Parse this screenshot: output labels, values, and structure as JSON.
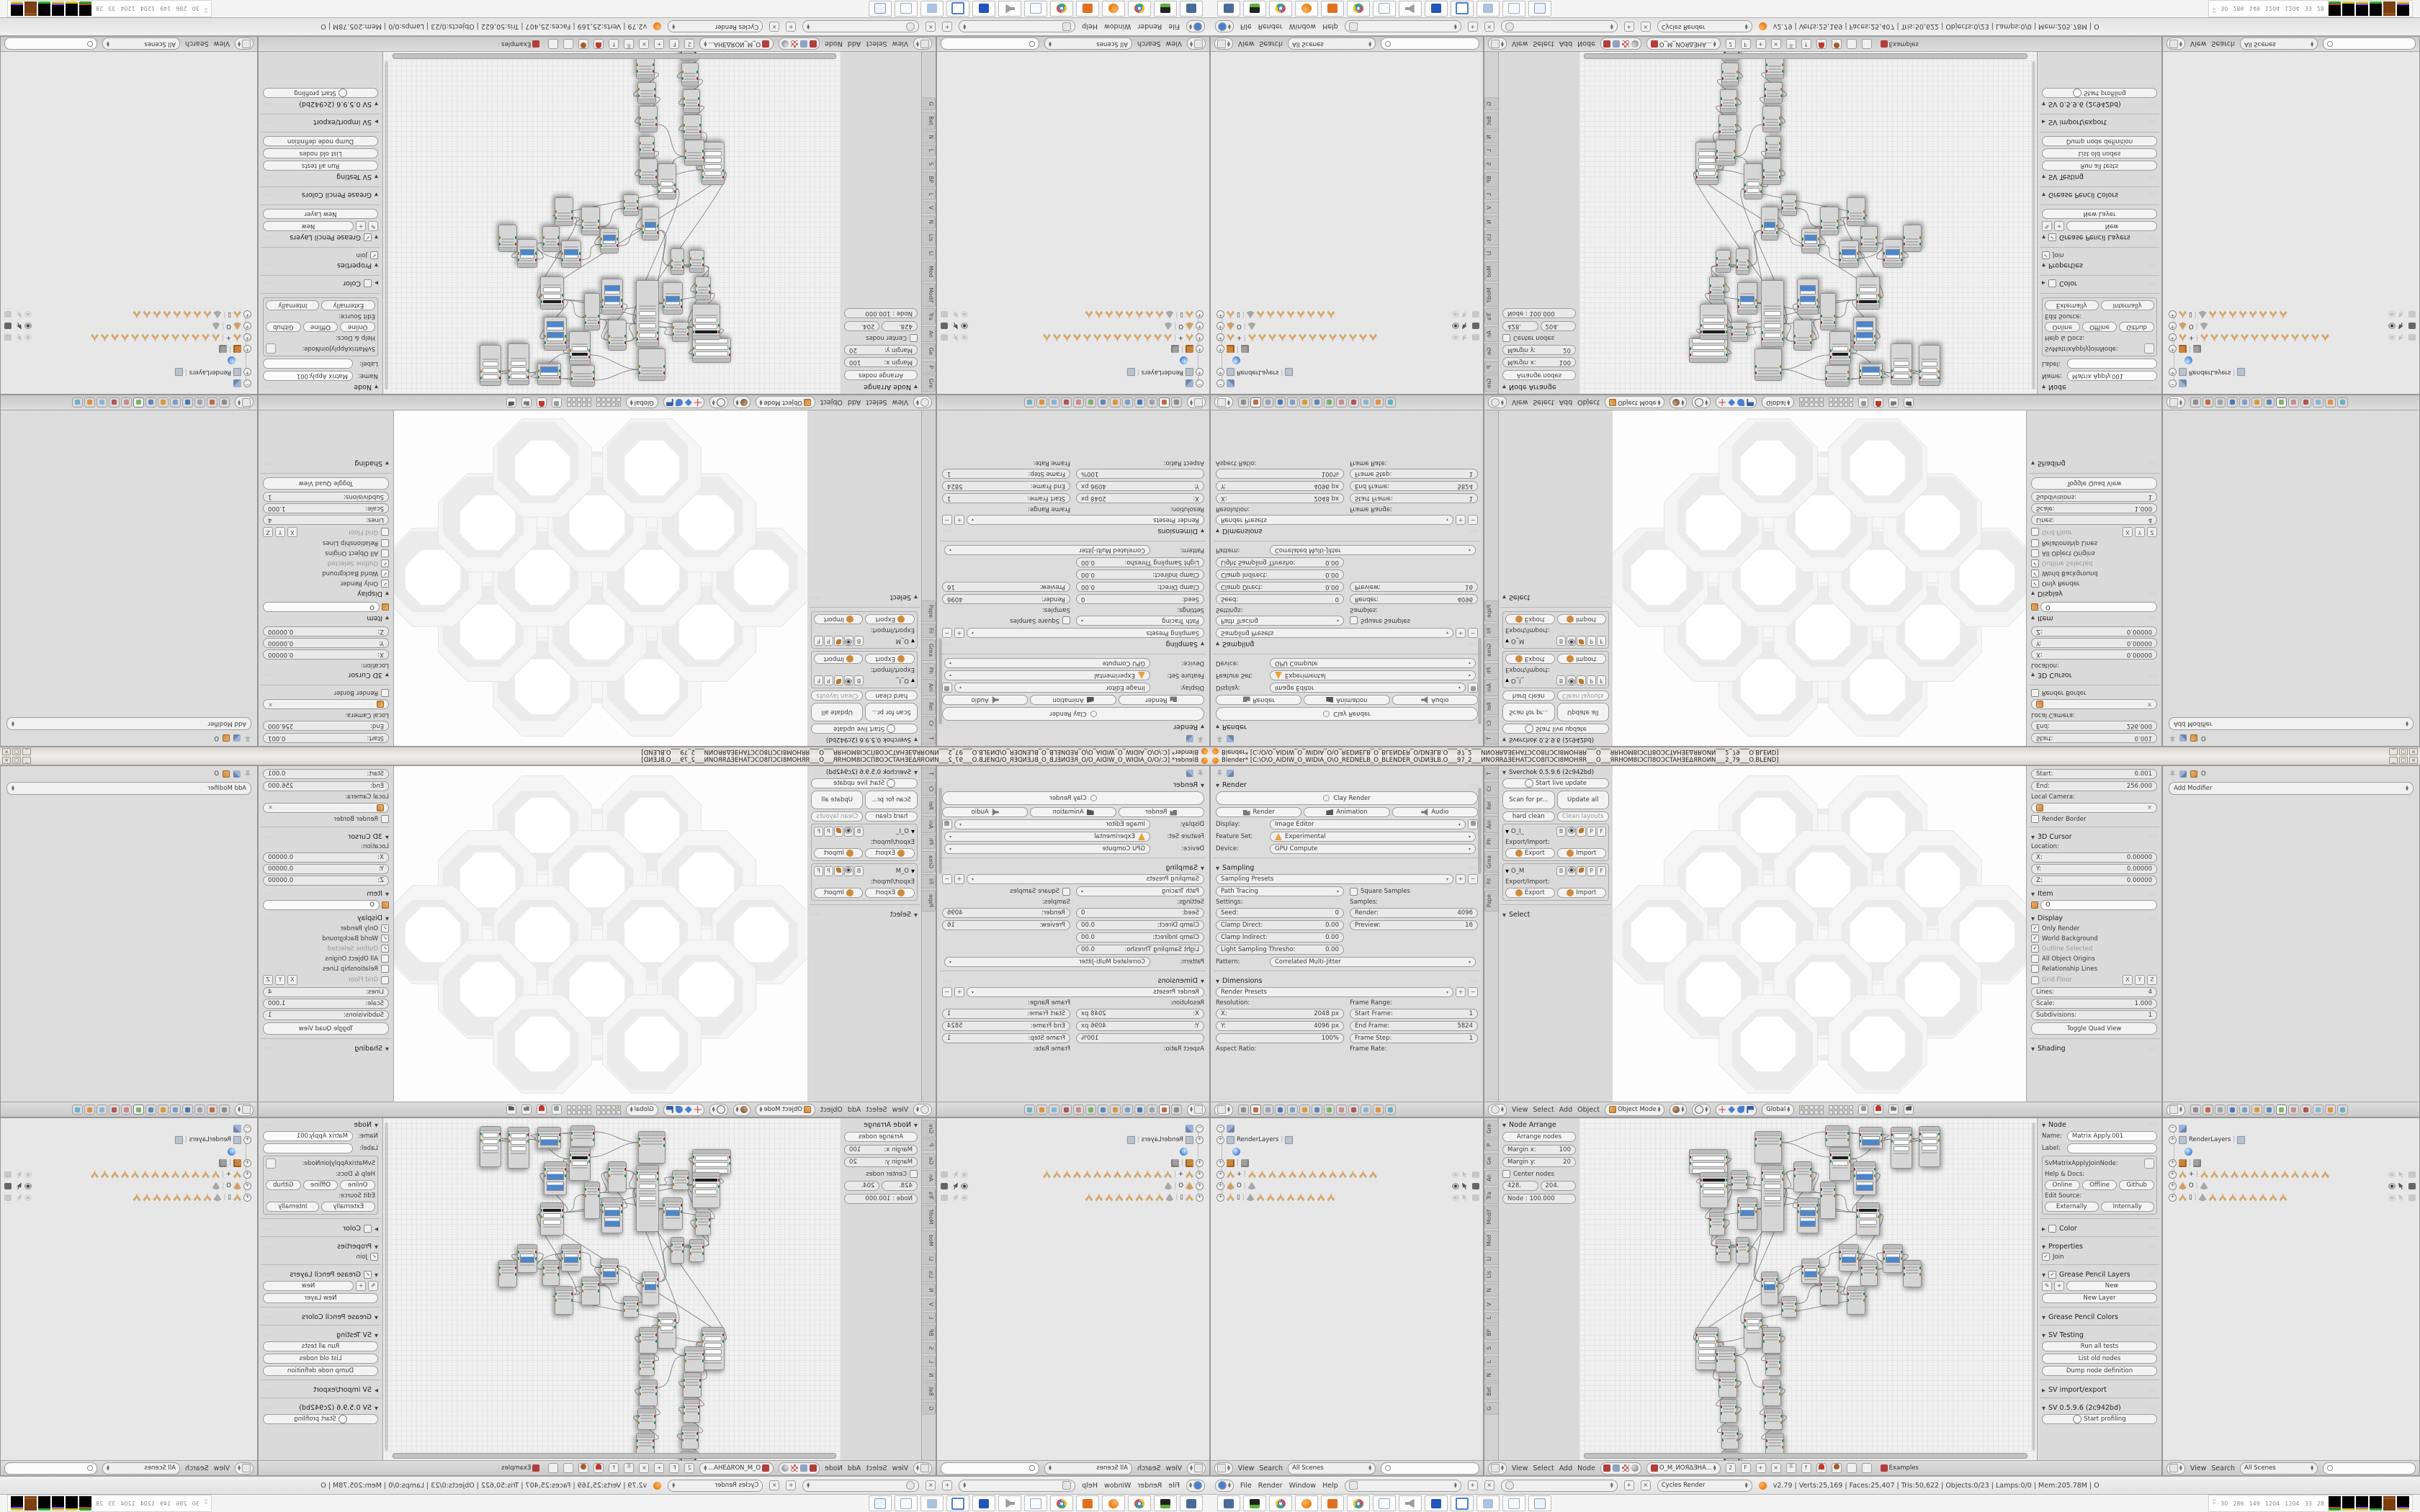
{
  "window": {
    "title": "Blender* [C:\\O\\O_AIDIW_O_WIDIA_O\\O_REDNELB_O_BLENDER_O\\DИƎLB.O___97_2___ИNOЯRΔƎEHATƆCO8ПƆCI8MOHЯR___O___ЯRHOM8IƆCП8OƆCTAHƎEΔЯROИN___2_79___O.BLEND]",
    "controls": [
      "_",
      "□",
      "×"
    ]
  },
  "accent": {
    "blender_orange": "#e87d0d",
    "slider_blue": "#4d86cc",
    "selection_tan": "#d6a76f"
  },
  "props1": {
    "render": {
      "title": "Render",
      "clay": "Clay Render",
      "r3": [
        "Render",
        "Animation",
        "Audio"
      ],
      "display_l": "Display:",
      "display": "Image Editor",
      "feature_l": "Feature Set:",
      "feature": "Experimental",
      "device_l": "Device:",
      "device": "GPU Compute"
    },
    "sampling": {
      "title": "Sampling",
      "presets": "Sampling Presets",
      "integrator": "Path Tracing",
      "square": "Square Samples",
      "settings_l": "Settings:",
      "samples_l": "Samples:",
      "left": [
        [
          "Seed:",
          "0"
        ],
        [
          "Clamp Direct:",
          "0.00"
        ],
        [
          "Clamp Indirect:",
          "0.00"
        ],
        [
          "Light Sampling Thresho:",
          "0.00"
        ]
      ],
      "right": [
        [
          "Render:",
          "4096"
        ],
        [
          "Preview:",
          "16"
        ]
      ],
      "pattern_l": "Pattern:",
      "pattern": "Correlated Multi-Jitter"
    },
    "dimensions": {
      "title": "Dimensions",
      "presets": "Render Presets",
      "res_l": "Resolution:",
      "range_l": "Frame Range:",
      "left": [
        [
          "X:",
          "2048 px"
        ],
        [
          "Y:",
          "4096 px"
        ],
        [
          "",
          "100%"
        ]
      ],
      "right": [
        [
          "Start Frame:",
          "1"
        ],
        [
          "End Frame:",
          "5824"
        ],
        [
          "Frame Step:",
          "1"
        ]
      ],
      "aspect_l": "Aspect Ratio:",
      "rate_l": "Frame Rate:"
    }
  },
  "shelf3d": {
    "tabs": [
      "T",
      "Cr",
      "Rel",
      "Ani",
      "Ph",
      "Grea",
      "Fil",
      "Pape"
    ],
    "title": "Sverchok 0.5.9.6 (2c942bd)",
    "live": "Start live update",
    "pair1": [
      "Scan for pr...",
      "Update all"
    ],
    "pair2": [
      "hard clean",
      "Clean layouts"
    ],
    "io_boxes": [
      {
        "label": "O_I_"
      },
      {
        "label": "O_M"
      }
    ],
    "io_btns": [
      "B",
      "P",
      "F"
    ],
    "exio_l": "Export/Import:",
    "exp": "Export",
    "imp": "Import",
    "select_t": "Select"
  },
  "npanel3d": {
    "clip": [
      [
        "Start:",
        "0.001"
      ],
      [
        "End:",
        "256.000"
      ]
    ],
    "localcam_l": "Local Camera:",
    "renderborder": "Render Border",
    "cursor_t": "3D Cursor",
    "location_l": "Location:",
    "loc": [
      [
        "X:",
        "0.00000"
      ],
      [
        "Y:",
        "0.00000"
      ],
      [
        "Z:",
        "0.00000"
      ]
    ],
    "item_t": "Item",
    "item_val": "O",
    "display_t": "Display",
    "checks": [
      {
        "t": "Only Render",
        "c": 1
      },
      {
        "t": "World Background",
        "c": 1
      },
      {
        "t": "Outline Selected",
        "c": 1,
        "dim": 1
      },
      {
        "t": "All Object Origins",
        "c": 0
      },
      {
        "t": "Relationship Lines",
        "c": 0
      }
    ],
    "gridfloor": "Grid Floor",
    "xyz": [
      "X",
      "Y",
      "Z"
    ],
    "gridvals": [
      [
        "Lines:",
        "4"
      ],
      [
        "Scale:",
        "1.000"
      ],
      [
        "Subdivisions:",
        "1"
      ]
    ],
    "quadview": "Toggle Quad View",
    "shading_t": "Shading"
  },
  "props2": {
    "crumb_obj": "O",
    "add_modifier": "Add Modifier"
  },
  "hdr3d": {
    "menus": [
      "View",
      "Select",
      "Add",
      "Object"
    ],
    "mode": "Object Mode",
    "space": "Global"
  },
  "outliner": {
    "menus": [
      "View",
      "Search"
    ],
    "scenes": "All Scenes",
    "rows": [
      {
        "e": "-",
        "i": [
          "tools"
        ],
        "t": ""
      },
      {
        "e": "+",
        "i": [
          "pic"
        ],
        "t": "RenderLayers",
        "x": [
          "pic"
        ]
      },
      {
        "e": "",
        "i": [
          "world"
        ],
        "t": "",
        "ind": 1
      },
      {
        "e": "+",
        "i": [
          "blocks"
        ],
        "t": "",
        "x": [
          "blocksg"
        ]
      },
      {
        "e": "+",
        "i": [
          "tri"
        ],
        "t": "+",
        "x": [
          "tri",
          "tri",
          "tri",
          "tri",
          "tri",
          "tri",
          "tri",
          "tri",
          "tri",
          "tri",
          "tri",
          "tri",
          "tri"
        ],
        "v": 0
      },
      {
        "e": "+",
        "i": [
          "cone"
        ],
        "t": "O",
        "x": [
          "coneg"
        ],
        "v": 1
      },
      {
        "e": "+",
        "i": [
          "tri"
        ],
        "t": "▯",
        "x": [
          "coneg",
          "tri",
          "tri",
          "tri",
          "tri",
          "tri",
          "tri",
          "tri",
          "tri"
        ],
        "v": 0
      }
    ]
  },
  "nodeshelf": {
    "tabs": [
      "Gre",
      "P",
      "Ge",
      "An",
      "Tra",
      "Modif",
      "Mod",
      "Li",
      "Lis",
      "N",
      "V",
      "L",
      "BP",
      "S",
      "L",
      "N",
      "Bet",
      "G"
    ],
    "title": "Node Arrange",
    "arrange": "Arrange nodes",
    "kv": [
      [
        "Margin x:",
        "100"
      ],
      [
        "Margin y:",
        "20"
      ]
    ],
    "center": "Center nodes",
    "pair": [
      "428.",
      "204."
    ],
    "node100": "Node : 100.000"
  },
  "nodenp": {
    "title": "Node",
    "name_l": "Name:",
    "name": "Matrix Apply.001",
    "label_l": "Label:",
    "cls": "SvMatrixApplyJoinNode:",
    "help_l": "Help & Docs:",
    "docs": [
      "Online",
      "Offline",
      "Github"
    ],
    "editsrc_l": "Edit Source:",
    "src": [
      "Externally",
      "Internally"
    ],
    "color_t": "Color",
    "props_t": "Properties",
    "join": "Join",
    "gpl_t": "Grease Pencil Layers",
    "new_b": "New",
    "newlayer_b": "New Layer",
    "gpc_t": "Grease Pencil Colors",
    "svtest_t": "SV Testing",
    "tests": [
      "Run all tests",
      "List old nodes",
      "Dump node definition"
    ],
    "svio_t": "SV import/export",
    "svver_t": "SV 0.5.9.6 (2c942bd)",
    "profiling": "Start profiling"
  },
  "nodehdr": {
    "menus": [
      "View",
      "Select",
      "Add",
      "Node"
    ],
    "tree": "O_M_ИOЯΔƎHA...",
    "num": "2",
    "f": "F",
    "examples": "Examples"
  },
  "infobar": {
    "menus": [
      "File",
      "Render",
      "Window",
      "Help"
    ],
    "engine": "Cycles Render",
    "stats": "v2.79 | Verts:25,169 | Faces:25,407 | Tris:50,622 | Objects:0/23 | Lamps:0/0 | Mem:205.78M | O"
  },
  "taskbar": {
    "icons": [
      "monitor",
      "drive",
      "chrome",
      "blender",
      "swirl",
      "chrome",
      "note",
      "speaker",
      "floppy",
      "frame",
      "calc",
      "note",
      "note2"
    ],
    "tray_nums": [
      "30",
      "286",
      "149",
      "1204",
      "1204",
      "33",
      "28"
    ],
    "tray_graphs": [
      [
        "#27a327",
        "#c03c2e"
      ],
      [
        "#d6c42a"
      ],
      [
        "#d6c42a",
        "#8a3cf0"
      ],
      [
        "#2fb52f"
      ],
      [
        "#8a4a17"
      ],
      [
        "#d6c42a",
        "#8a3cf0"
      ]
    ]
  },
  "lattice": {
    "r": 74,
    "cells": [
      [
        216,
        82
      ],
      [
        368,
        82
      ],
      [
        140,
        158
      ],
      [
        292,
        158
      ],
      [
        444,
        158
      ],
      [
        64,
        234
      ],
      [
        216,
        234
      ],
      [
        368,
        234
      ],
      [
        520,
        234
      ],
      [
        140,
        310
      ],
      [
        292,
        310
      ],
      [
        444,
        310
      ],
      [
        216,
        386
      ],
      [
        368,
        386
      ]
    ]
  },
  "node_graph": {
    "nodes": [
      [
        152,
        43,
        54,
        35,
        "s"
      ],
      [
        243,
        18,
        38,
        45,
        "c"
      ],
      [
        341,
        10,
        34,
        30,
        "c"
      ],
      [
        388,
        12,
        33,
        31,
        "b"
      ],
      [
        432,
        12,
        30,
        58,
        "s"
      ],
      [
        347,
        40,
        30,
        47,
        "k"
      ],
      [
        380,
        60,
        32,
        47,
        "B"
      ],
      [
        167,
        75,
        39,
        50,
        "kf"
      ],
      [
        210,
        72,
        24,
        28,
        "c"
      ],
      [
        219,
        110,
        28,
        45,
        "b"
      ],
      [
        252,
        65,
        32,
        93,
        "t"
      ],
      [
        297,
        60,
        26,
        43,
        "c"
      ],
      [
        302,
        110,
        30,
        50,
        "B"
      ],
      [
        334,
        88,
        22,
        52,
        "c"
      ],
      [
        384,
        117,
        33,
        46,
        "kf"
      ],
      [
        180,
        130,
        22,
        33,
        "c"
      ],
      [
        189,
        168,
        21,
        32,
        "c"
      ],
      [
        217,
        165,
        19,
        37,
        "c"
      ],
      [
        252,
        213,
        24,
        47,
        "b"
      ],
      [
        280,
        247,
        22,
        30,
        "c"
      ],
      [
        308,
        195,
        26,
        35,
        "b"
      ],
      [
        334,
        220,
        26,
        40,
        "c"
      ],
      [
        360,
        175,
        28,
        38,
        "b"
      ],
      [
        390,
        197,
        24,
        36,
        "c"
      ],
      [
        421,
        175,
        28,
        40,
        "b"
      ],
      [
        449,
        197,
        26,
        38,
        "c"
      ],
      [
        371,
        233,
        26,
        40,
        "c"
      ],
      [
        228,
        270,
        26,
        50,
        "f"
      ],
      [
        161,
        290,
        32,
        60,
        "F"
      ],
      [
        189,
        317,
        28,
        36,
        "c"
      ],
      [
        254,
        290,
        26,
        37,
        "c"
      ],
      [
        258,
        328,
        22,
        30,
        "c"
      ],
      [
        193,
        353,
        26,
        35,
        "c"
      ],
      [
        195,
        390,
        24,
        33,
        "c"
      ],
      [
        197,
        427,
        24,
        33,
        "c"
      ],
      [
        200,
        463,
        23,
        27,
        "c"
      ],
      [
        254,
        363,
        26,
        37,
        "c"
      ],
      [
        256,
        403,
        26,
        30,
        "c"
      ],
      [
        258,
        437,
        26,
        30,
        "c"
      ],
      [
        471,
        11,
        30,
        57,
        "s"
      ]
    ],
    "wires": [
      [
        0,
        7
      ],
      [
        1,
        2
      ],
      [
        2,
        3
      ],
      [
        1,
        5
      ],
      [
        5,
        6
      ],
      [
        5,
        4
      ],
      [
        3,
        4
      ],
      [
        6,
        14
      ],
      [
        7,
        14
      ],
      [
        8,
        10
      ],
      [
        7,
        10
      ],
      [
        9,
        11
      ],
      [
        10,
        11
      ],
      [
        10,
        13
      ],
      [
        11,
        12
      ],
      [
        11,
        13
      ],
      [
        12,
        14
      ],
      [
        13,
        14
      ],
      [
        7,
        15
      ],
      [
        13,
        15
      ],
      [
        7,
        16
      ],
      [
        15,
        16
      ],
      [
        16,
        17
      ],
      [
        17,
        18
      ],
      [
        9,
        18
      ],
      [
        18,
        19
      ],
      [
        18,
        20
      ],
      [
        19,
        21
      ],
      [
        20,
        21
      ],
      [
        20,
        22
      ],
      [
        21,
        26
      ],
      [
        22,
        23
      ],
      [
        23,
        24
      ],
      [
        24,
        25
      ],
      [
        22,
        25
      ],
      [
        14,
        26
      ],
      [
        26,
        27
      ],
      [
        10,
        27
      ],
      [
        27,
        30
      ],
      [
        28,
        29
      ],
      [
        28,
        30
      ],
      [
        29,
        30
      ],
      [
        30,
        31
      ],
      [
        28,
        32
      ],
      [
        32,
        33
      ],
      [
        33,
        34
      ],
      [
        34,
        35
      ],
      [
        29,
        36
      ],
      [
        36,
        37
      ],
      [
        37,
        38
      ],
      [
        4,
        39
      ],
      [
        14,
        28
      ],
      [
        10,
        28
      ]
    ]
  }
}
